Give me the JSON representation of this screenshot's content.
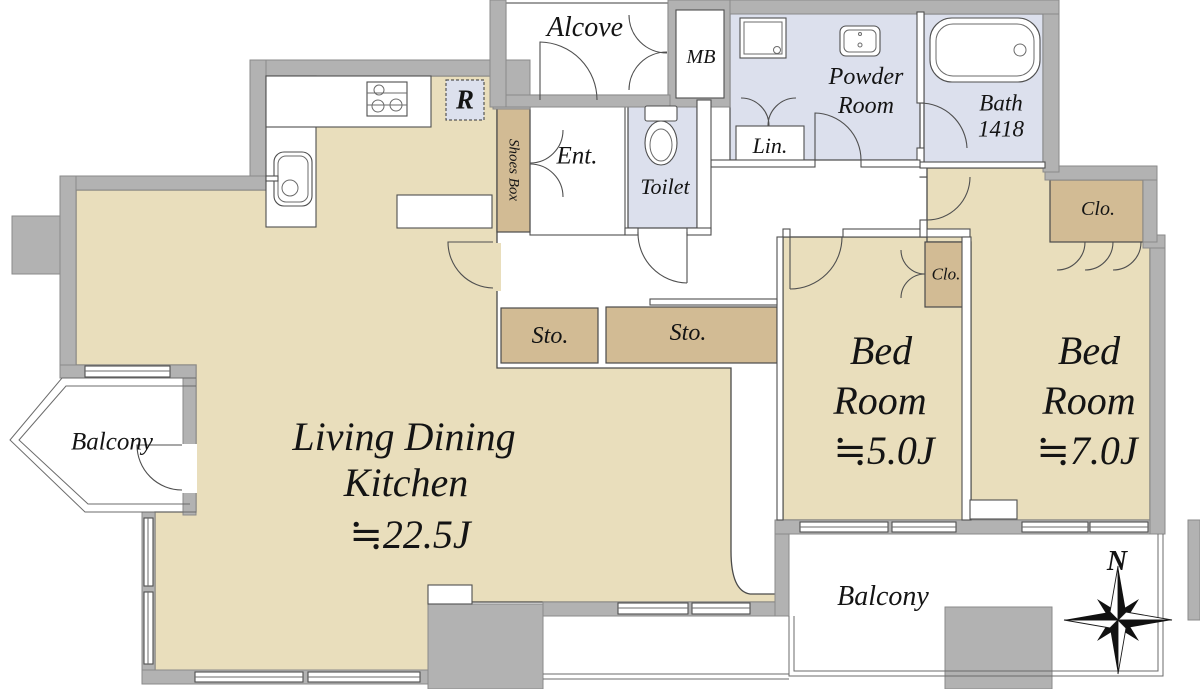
{
  "plan": {
    "colors": {
      "floor": "#e9debc",
      "storage": "#d2bb94",
      "wet": "#dce0ed",
      "wall": "#b2b2b2"
    },
    "rooms": {
      "alcove": {
        "label": "Alcove"
      },
      "meter_box": {
        "label": "MB"
      },
      "powder_room": {
        "line1": "Powder",
        "line2": "Room"
      },
      "bath": {
        "label": "Bath",
        "size": "1418"
      },
      "linen": {
        "label": "Lin."
      },
      "toilet": {
        "label": "Toilet"
      },
      "entrance": {
        "label": "Ent."
      },
      "shoes_box": {
        "label": "Shoes Box"
      },
      "refrigerator_space": {
        "label": "R"
      },
      "storage_1": {
        "label": "Sto."
      },
      "storage_2": {
        "label": "Sto."
      },
      "living_dining_kitchen": {
        "line1": "Living Dining",
        "line2": "Kitchen",
        "size": "≒22.5J"
      },
      "bedroom_5j": {
        "line1": "Bed",
        "line2": "Room",
        "size": "≒5.0J"
      },
      "bedroom_7j": {
        "line1": "Bed",
        "line2": "Room",
        "size": "≒7.0J"
      },
      "closet_bedroom_5j": {
        "label": "Clo."
      },
      "closet_bedroom_7j": {
        "label": "Clo."
      },
      "balcony_side": {
        "label": "Balcony"
      },
      "balcony_main": {
        "label": "Balcony"
      }
    },
    "compass": {
      "north": "N"
    }
  }
}
